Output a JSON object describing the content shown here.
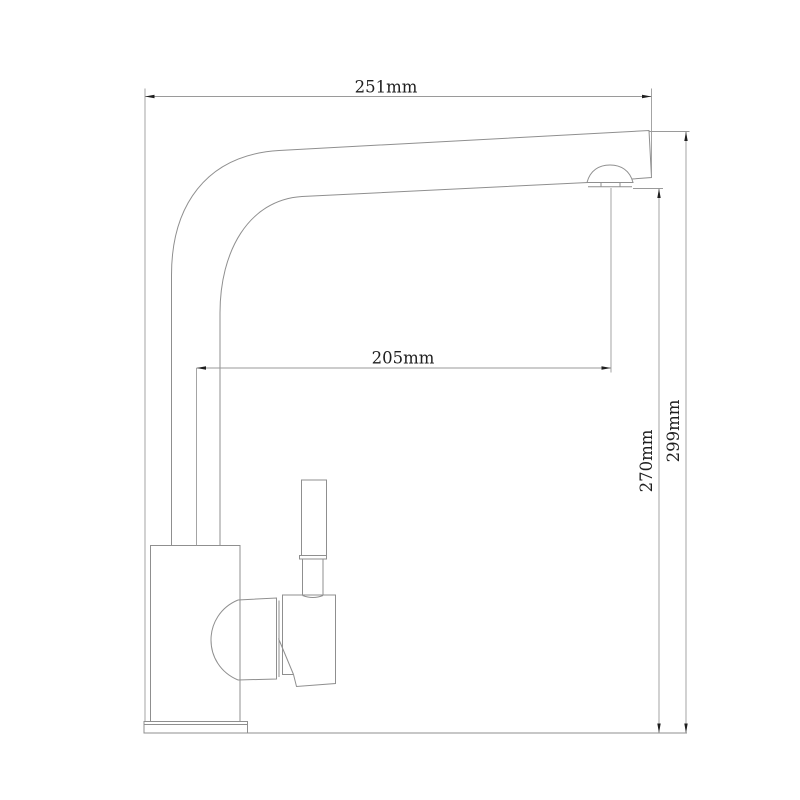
{
  "drawing": {
    "subject": "kitchen faucet side elevation technical drawing",
    "dimension_labels": {
      "top_width": "251mm",
      "spout_reach": "205mm",
      "spout_outlet_height": "270mm",
      "overall_height": "299mm"
    }
  },
  "colors": {
    "background": "#ffffff",
    "outline": "#8f8f8f",
    "dimension_line": "#9a9a9a",
    "text": "#1f1f1f"
  }
}
